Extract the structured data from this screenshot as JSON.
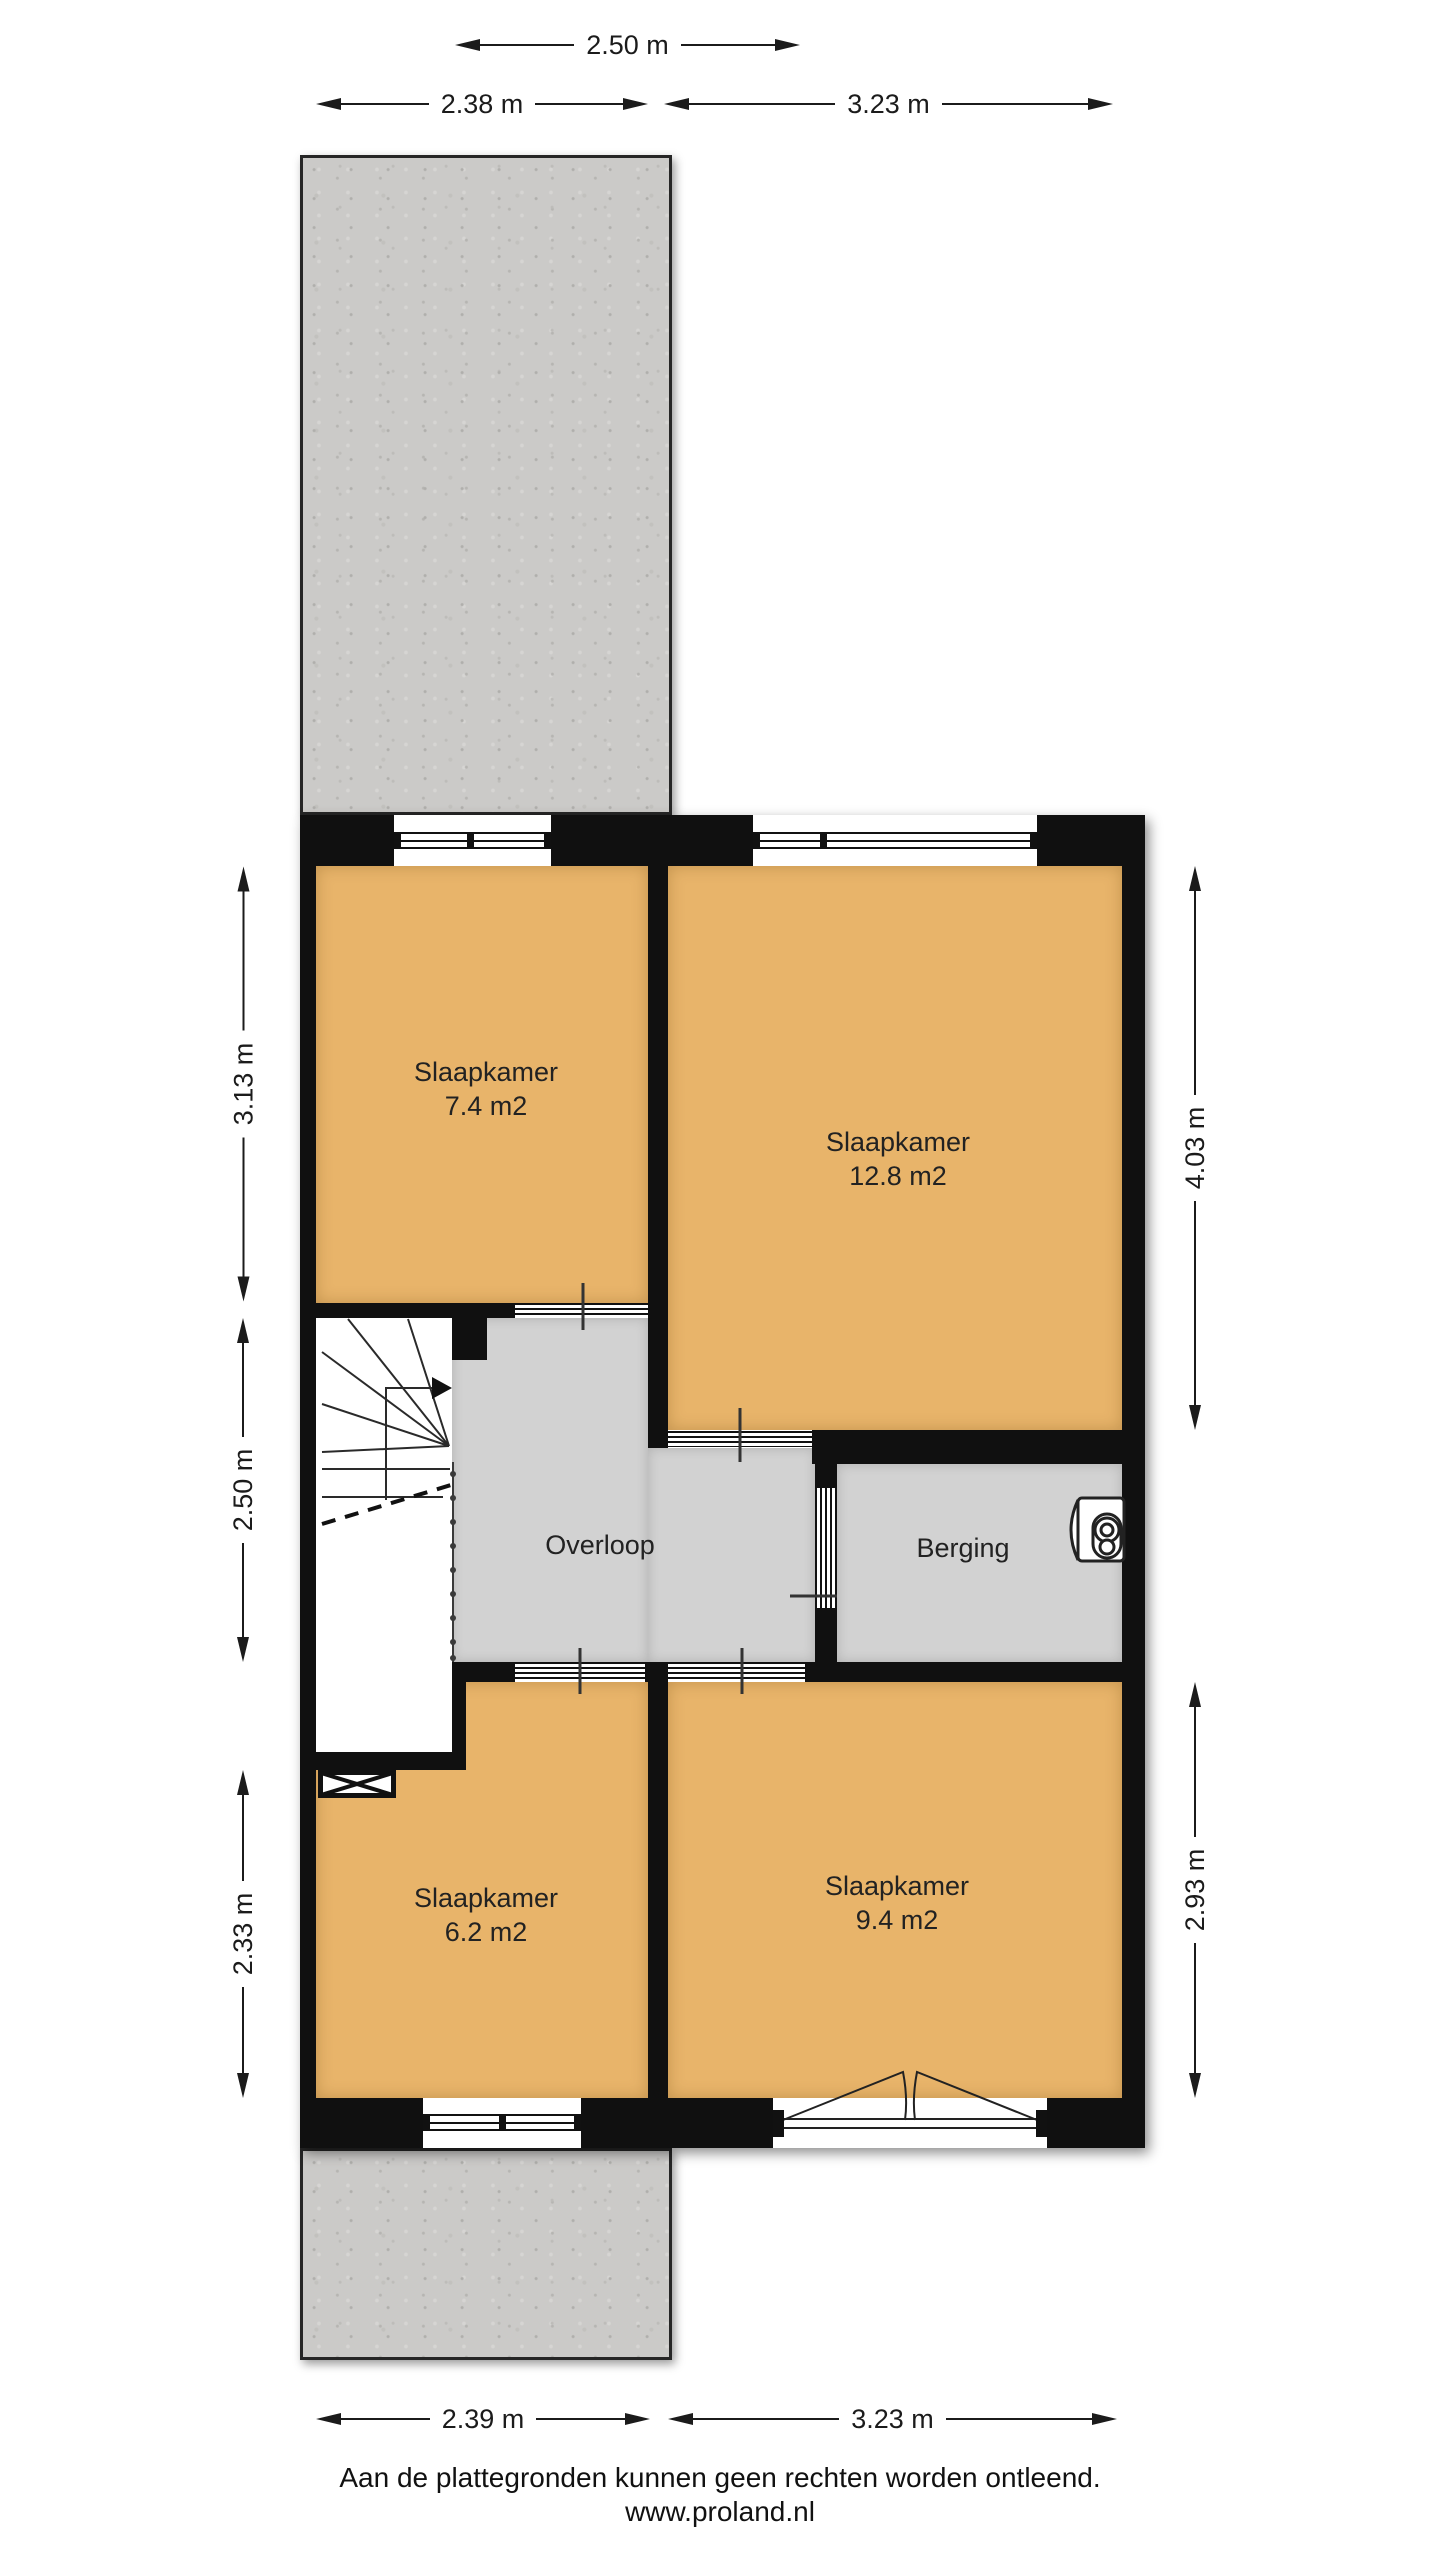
{
  "colors": {
    "room-fill": "#e8b46a",
    "hall-fill": "#d2d2d2",
    "wall": "#101010",
    "terrace-fill": "#cbcac8",
    "text": "#1b1b1b"
  },
  "dimensions": {
    "top_row1": "2.50 m",
    "top_row2_left": "2.38 m",
    "top_row2_right": "3.23 m",
    "left_upper": "3.13 m",
    "left_middle": "2.50 m",
    "left_lower": "2.33 m",
    "right_upper": "4.03 m",
    "right_lower": "2.93 m",
    "bottom_left": "2.39 m",
    "bottom_right": "3.23 m"
  },
  "rooms": {
    "bedroom_nw": {
      "name": "Slaapkamer",
      "area": "7.4 m2"
    },
    "bedroom_ne": {
      "name": "Slaapkamer",
      "area": "12.8 m2"
    },
    "landing": {
      "name": "Overloop"
    },
    "storage": {
      "name": "Berging"
    },
    "bedroom_sw": {
      "name": "Slaapkamer",
      "area": "6.2 m2"
    },
    "bedroom_se": {
      "name": "Slaapkamer",
      "area": "9.4 m2"
    }
  },
  "footer": {
    "disclaimer": "Aan de plattegronden kunnen geen rechten worden ontleend.",
    "website": "www.proland.nl"
  }
}
